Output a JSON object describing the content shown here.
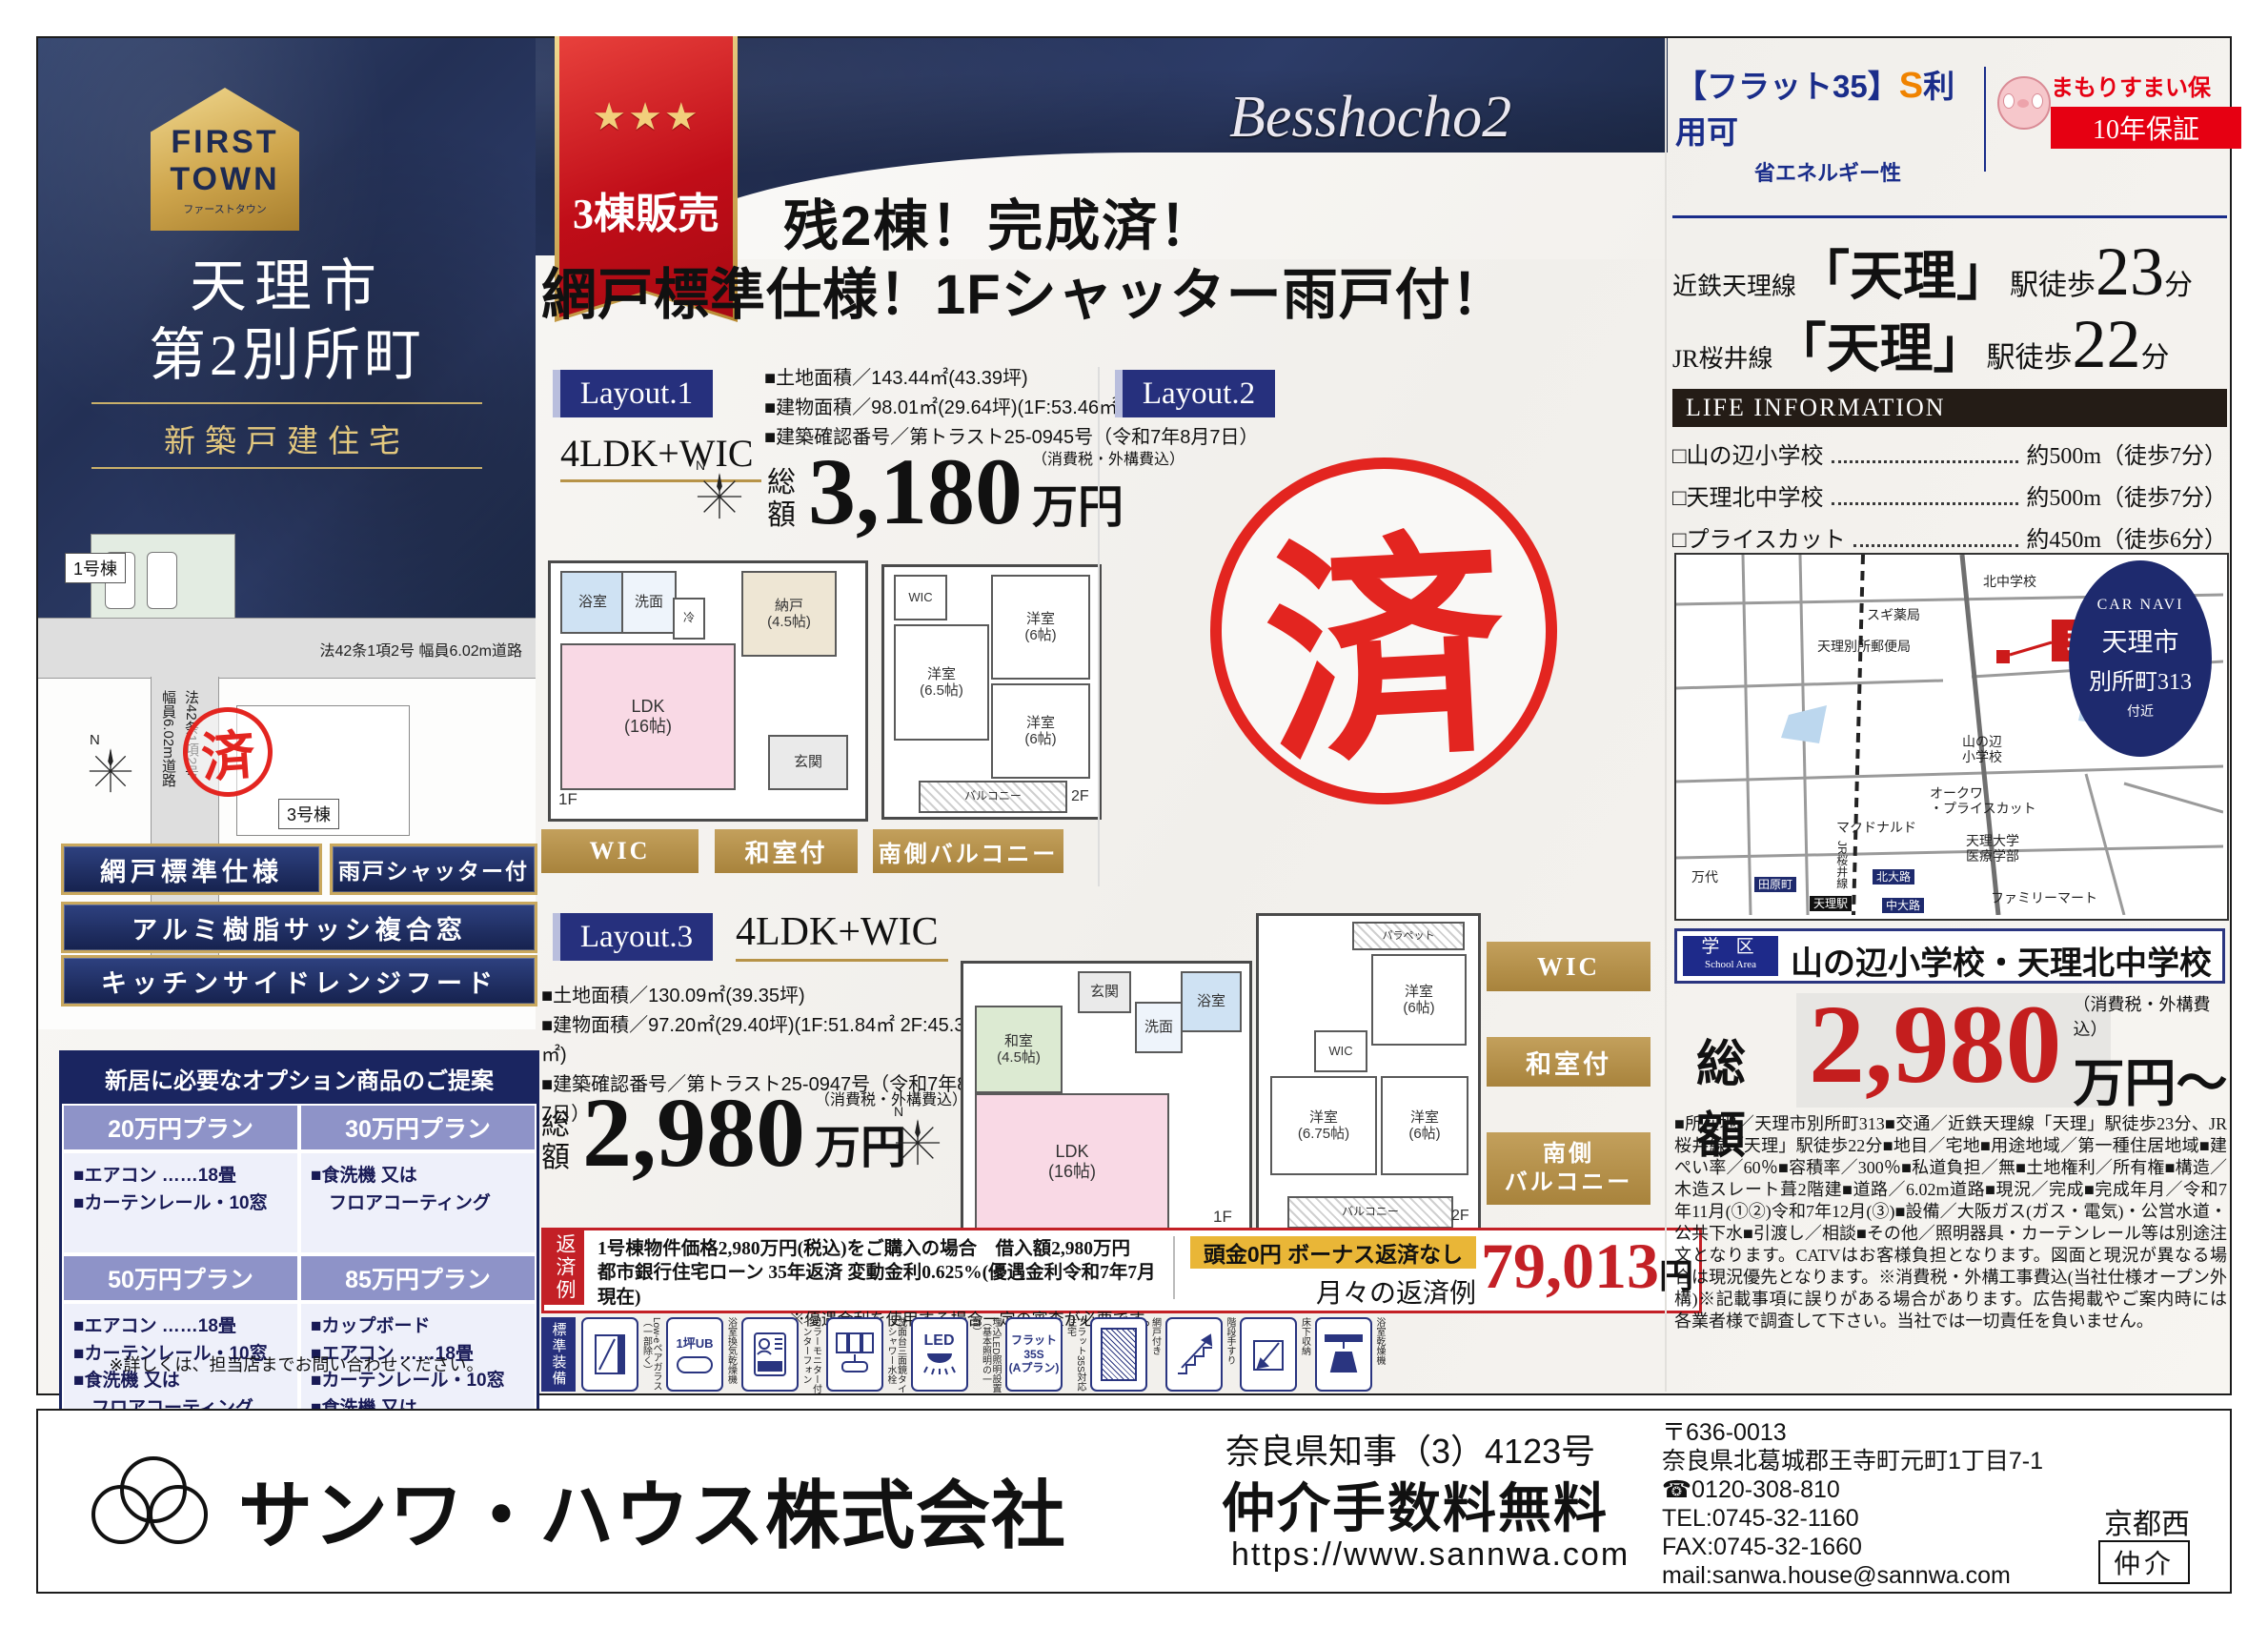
{
  "brand": {
    "first": "FIRST",
    "town": "TOWN",
    "kana": "ファーストタウン",
    "city": "天理市",
    "district": "第2別所町",
    "subtitle": "新築戸建住宅"
  },
  "ribbon": {
    "stars": "★★★",
    "label": "3棟販売"
  },
  "headline": {
    "line1": "残2棟！完成済！",
    "line2": "網戸標準仕様！1Fシャッター雨戸付！"
  },
  "banner": {
    "script": "Besshocho2"
  },
  "flat35": {
    "bracket": "【フラット35】",
    "s": "S",
    "use": "利用可",
    "energy": "省エネルギー性"
  },
  "insurance": {
    "name": "まもりすまい保険",
    "warranty": "10年保証"
  },
  "stations": [
    {
      "line": "近鉄天理線",
      "station": "「天理」",
      "walk": "駅徒歩",
      "min": "23",
      "unit": "分"
    },
    {
      "line": "JR桜井線",
      "station": "「天理」",
      "walk": "駅徒歩",
      "min": "22",
      "unit": "分"
    }
  ],
  "life": {
    "title": "LIFE INFORMATION",
    "items": [
      {
        "label": "□山の辺小学校",
        "value": "約500m（徒歩7分）"
      },
      {
        "label": "□天理北中学校",
        "value": "約500m（徒歩7分）"
      },
      {
        "label": "□プライスカット",
        "value": "約450m（徒歩6分）"
      }
    ]
  },
  "map": {
    "genchi": "現地",
    "carnavi": {
      "title": "CAR NAVI",
      "line1": "天理市",
      "line2": "別所町313",
      "line3": "付近"
    },
    "poi": {
      "kitachu": "北中学校",
      "sugi": "スギ薬局",
      "post": "天理別所郵便局",
      "yamanobe": "山の辺\n小学校",
      "okuwa": "オークワ\n・プライスカット",
      "mac": "マクドナルド",
      "tendai": "天理大学\n医療学部",
      "famima": "ファミリーマート",
      "mandai": "万代",
      "tawara": "田原町",
      "kitaoji": "北大路",
      "nakaoji": "中大路",
      "tenri_station": "天理駅",
      "jr_line": "JR桜井線"
    }
  },
  "school": {
    "tag": "学 区",
    "tag_en": "School Area",
    "value": "山の辺小学校・天理北中学校"
  },
  "total": {
    "prefix": "総額",
    "amount": "2,980",
    "note": "（消費税・外構費込）",
    "suffix": "万円〜"
  },
  "details": {
    "text": "■所在地／天理市別所町313■交通／近鉄天理線「天理」駅徒歩23分、JR桜井線「天理」駅徒歩22分■地目／宅地■用途地域／第一種住居地域■建ぺい率／60％■容積率／300％■私道負担／無■土地権利／所有権■構造／木造スレート葺2階建■道路／6.02m道路■現況／完成■完成年月／令和7年11月(①②)令和7年12月(③)■設備／大阪ガス(ガス・電気)・公営水道・公共下水■引渡し／相談■その他／照明器具・カーテンレール等は別途注文となります。CATVはお客様負担となります。図面と現況が異なる場合は現況優先となります。※消費税・外構工事費込(当社仕様オープン外構)※記載事項に誤りがある場合があります。広告掲載やご案内時には各業者様で調査して下さい。当社では一切責任を負いません。"
  },
  "site": {
    "h1": "1号棟",
    "h3": "3号棟",
    "stamp": "済",
    "road_h": "法42条1項2号 幅員6.02m道路",
    "road_v": "法42条1項2号\n幅員6.02m道路",
    "width": "8.02m",
    "north": "N"
  },
  "features": [
    "網戸標準仕様",
    "雨戸シャッター付",
    "アルミ樹脂サッシ複合窓",
    "キッチンサイドレンジフード"
  ],
  "options": {
    "title": "新居に必要なオプション商品のご提案",
    "plans": [
      {
        "name": "20万円プラン",
        "items": "■エアコン ……18畳\n■カーテンレール・10窓"
      },
      {
        "name": "30万円プラン",
        "items": "■食洗機 又は\n　フロアコーティング"
      },
      {
        "name": "50万円プラン",
        "items": "■エアコン ……18畳\n■カーテンレール・10窓\n■食洗機 又は\n　フロアコーティング"
      },
      {
        "name": "85万円プラン",
        "items": "■カップボード\n■エアコン ……18畳\n■カーテンレール・10窓\n■食洗機 又は\n　フロアコーティング"
      }
    ],
    "note": "※詳しくは、担当店までお問い合わせください。"
  },
  "layout1": {
    "tag": "Layout.1",
    "type": "4LDK+WIC",
    "specs": [
      "■土地面積／143.44㎡(43.39坪)",
      "■建物面積／98.01㎡(29.64坪)(1F:53.46㎡ 2F:44.55㎡)",
      "■建築確認番号／第トラスト25-0945号（令和7年8月7日）"
    ],
    "price": {
      "prefix": "総額",
      "amount": "3,180",
      "note": "（消費税・外構費込）",
      "suffix": "万円"
    },
    "f1": {
      "label": "1F",
      "rooms": [
        "浴室",
        "洗面",
        "納戸\n(4.5帖)",
        "LDK\n(16帖)",
        "玄関",
        "冷"
      ]
    },
    "f2": {
      "label": "2F",
      "rooms": [
        "WIC",
        "洋室\n(6帖)",
        "洋室\n(6.5帖)",
        "洋室\n(6帖)",
        "バルコニー"
      ]
    },
    "tags": [
      "WIC",
      "和室付",
      "南側バルコニー"
    ]
  },
  "layout2": {
    "tag": "Layout.2",
    "stamp": "済"
  },
  "layout3": {
    "tag": "Layout.3",
    "type": "4LDK+WIC",
    "specs": [
      "■土地面積／130.09㎡(39.35坪)",
      "■建物面積／97.20㎡(29.40坪)(1F:51.84㎡ 2F:45.36㎡)",
      "■建築確認番号／第トラスト25-0947号（令和7年8月7日）"
    ],
    "price": {
      "prefix": "総額",
      "amount": "2,980",
      "note": "（消費税・外構費込）",
      "suffix": "万円"
    },
    "f1": {
      "label": "1F",
      "rooms": [
        "和室\n(4.5帖)",
        "玄関",
        "洗面",
        "浴室",
        "LDK\n(16帖)"
      ]
    },
    "f2": {
      "label": "2F",
      "rooms": [
        "パラペット",
        "洋室\n(6帖)",
        "WIC",
        "洋室\n(6.75帖)",
        "洋室\n(6帖)",
        "バルコニー"
      ]
    },
    "tags": [
      "WIC",
      "和室付",
      "南側\nバルコニー"
    ]
  },
  "repay": {
    "side": "返済例",
    "line1": "1号棟物件価格2,980万円(税込)をご購入の場合　借入額2,980万円",
    "line2": "都市銀行住宅ローン 35年返済 変動金利0.625%(優遇金利令和7年7月現在)",
    "line3": "※優遇金利を使用する場合一定の審査が必要です。",
    "highlight": "頭金0円 ボーナス返済なし",
    "monthly": "月々の返済例",
    "amount": "79,013",
    "unit": "円"
  },
  "equip": {
    "side": "標準装備",
    "items": [
      {
        "label": "Low-eペアガラス（一部除く）",
        "badge": ""
      },
      {
        "label": "浴室換気乾燥機",
        "badge": "1坪UB"
      },
      {
        "label": "カラーモニター付インターフォン",
        "badge": ""
      },
      {
        "label": "洗面台三面鏡タイプシャワー水栓",
        "badge": ""
      },
      {
        "label": "埋込LED照明設置（基本照明の一部）",
        "badge": "LED"
      },
      {
        "label": "フラット35S対応住宅",
        "badge": "フラット\n35S\n(Aプラン)"
      },
      {
        "label": "網戸付き",
        "badge": ""
      },
      {
        "label": "階段手すり",
        "badge": ""
      },
      {
        "label": "床下収納",
        "badge": ""
      },
      {
        "label": "浴室乾燥機",
        "badge": ""
      }
    ]
  },
  "footer": {
    "company": "サンワ・ハウス株式会社",
    "license": "奈良県知事（3）4123号",
    "fee": "仲介手数料無料",
    "url": "https://www.sannwa.com",
    "postal": "〒636-0013",
    "address": "奈良県北葛城郡王寺町元町1丁目7-1",
    "freedial": "☎0120-308-810",
    "tel": "TEL:0745-32-1160",
    "fax": "FAX:0745-32-1660",
    "mail": "mail:sanwa.house@sannwa.com",
    "branch": "京都西",
    "badge": "仲介"
  }
}
